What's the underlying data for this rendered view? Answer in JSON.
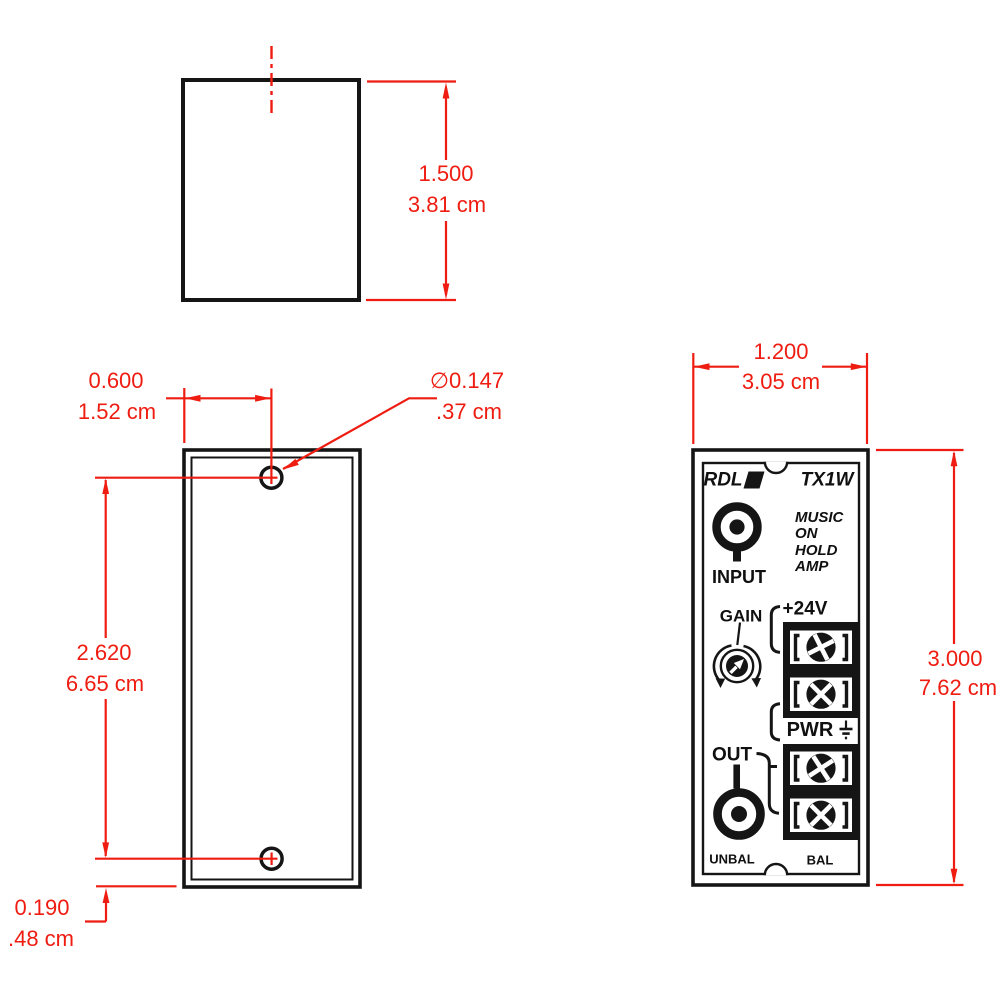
{
  "colors": {
    "dimension_red": "#ee1c11",
    "line_black": "#151515"
  },
  "side_view": {
    "height_in": "1.500",
    "height_cm": "3.81 cm"
  },
  "mounting_view": {
    "hole_offset_in": "0.600",
    "hole_offset_cm": "1.52 cm",
    "hole_diameter_in": "∅0.147",
    "hole_diameter_cm": ".37 cm",
    "hole_span_in": "2.620",
    "hole_span_cm": "6.65 cm",
    "bottom_offset_in": "0.190",
    "bottom_offset_cm": ".48 cm"
  },
  "panel_view": {
    "width_in": "1.200",
    "width_cm": "3.05 cm",
    "height_in": "3.000",
    "height_cm": "7.62 cm",
    "brand": "RDL",
    "model": "TX1W",
    "desc_line1": "MUSIC",
    "desc_line2": "ON",
    "desc_line3": "HOLD",
    "desc_line4": "AMP",
    "input_label": "INPUT",
    "gain_label": "GAIN",
    "supply_label": "+24V",
    "pwr_label": "PWR",
    "out_label": "OUT",
    "unbal_label": "UNBAL",
    "bal_label": "BAL"
  }
}
